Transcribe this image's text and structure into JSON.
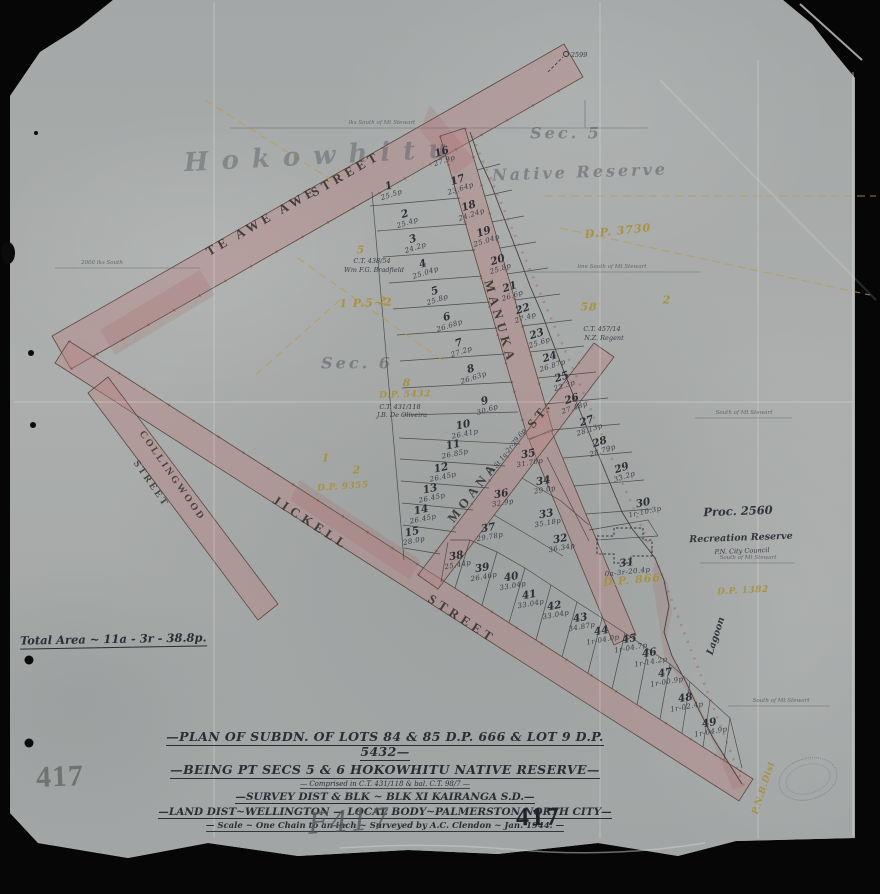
{
  "plan": {
    "total_area": "Total Area ~ 11a - 3r - 38.8p.",
    "title": {
      "l1": "—PLAN OF SUBDN. OF LOTS 84 & 85 D.P. 666 & LOT 9 D.P. 5432—",
      "l2": "—BEING PT SECS 5 & 6 HOKOWHITU NATIVE RESERVE—",
      "l3": "— Comprised in C.T. 431/118 & bal. C.T. 98/7 —",
      "l4": "—SURVEY DIST & BLK ~ BLK XI KAIRANGA S.D.—",
      "l5": "—LAND DIST~WELLINGTON — LOCAL BODY~PALMERSTON NORTH CITY—",
      "l6": "— Scale ~ One Chain to an inch ~ Surveyed by A.C. Clendon ~ Jan. 1944. —"
    },
    "numbers": {
      "stamp_grey": "417",
      "pencil": "F417",
      "ink": "417"
    }
  },
  "lots": [
    {
      "no": "1",
      "a": "25.5p",
      "x": 390,
      "y": 190,
      "r": -18
    },
    {
      "no": "2",
      "a": "25.4p",
      "x": 406,
      "y": 218,
      "r": -18
    },
    {
      "no": "3",
      "a": "24.2p",
      "x": 414,
      "y": 243,
      "r": -18
    },
    {
      "no": "4",
      "a": "25.04p",
      "x": 424,
      "y": 268,
      "r": -18
    },
    {
      "no": "5",
      "a": "25.8p",
      "x": 436,
      "y": 295,
      "r": -18
    },
    {
      "no": "6",
      "a": "26.68p",
      "x": 448,
      "y": 321,
      "r": -18
    },
    {
      "no": "7",
      "a": "27.2p",
      "x": 460,
      "y": 347,
      "r": -18
    },
    {
      "no": "8",
      "a": "26.63p",
      "x": 472,
      "y": 373,
      "r": -18
    },
    {
      "no": "9",
      "a": "30.6p",
      "x": 486,
      "y": 405,
      "r": -18
    },
    {
      "no": "10",
      "a": "26.41p",
      "x": 464,
      "y": 429,
      "r": -12
    },
    {
      "no": "11",
      "a": "26.85p",
      "x": 454,
      "y": 449,
      "r": -12
    },
    {
      "no": "12",
      "a": "26.45p",
      "x": 442,
      "y": 472,
      "r": -12
    },
    {
      "no": "13",
      "a": "26.45p",
      "x": 431,
      "y": 493,
      "r": -12
    },
    {
      "no": "14",
      "a": "26.45p",
      "x": 422,
      "y": 514,
      "r": -12
    },
    {
      "no": "15",
      "a": "28.0p",
      "x": 413,
      "y": 536,
      "r": -12
    },
    {
      "no": "16",
      "a": "27.9p",
      "x": 443,
      "y": 156,
      "r": -18
    },
    {
      "no": "17",
      "a": "23.64p",
      "x": 459,
      "y": 184,
      "r": -18
    },
    {
      "no": "18",
      "a": "24.24p",
      "x": 470,
      "y": 210,
      "r": -18
    },
    {
      "no": "19",
      "a": "25.04p",
      "x": 485,
      "y": 236,
      "r": -18
    },
    {
      "no": "20",
      "a": "25.8p",
      "x": 499,
      "y": 264,
      "r": -18
    },
    {
      "no": "21",
      "a": "26.6p",
      "x": 511,
      "y": 291,
      "r": -18
    },
    {
      "no": "22",
      "a": "27.4p",
      "x": 524,
      "y": 313,
      "r": -18
    },
    {
      "no": "23",
      "a": "25.6p",
      "x": 538,
      "y": 338,
      "r": -18
    },
    {
      "no": "24",
      "a": "26.87p",
      "x": 551,
      "y": 361,
      "r": -18
    },
    {
      "no": "25",
      "a": "22.3p",
      "x": 563,
      "y": 381,
      "r": -18
    },
    {
      "no": "26",
      "a": "27.48p",
      "x": 573,
      "y": 403,
      "r": -18
    },
    {
      "no": "27",
      "a": "28.13p",
      "x": 588,
      "y": 425,
      "r": -18
    },
    {
      "no": "28",
      "a": "28.79p",
      "x": 601,
      "y": 446,
      "r": -18
    },
    {
      "no": "29",
      "a": "33.2p",
      "x": 623,
      "y": 472,
      "r": -18
    },
    {
      "no": "30",
      "a": "1r-10.3p",
      "x": 644,
      "y": 507,
      "r": -12
    },
    {
      "no": "31",
      "a": "0a-3r-20.4p",
      "x": 627,
      "y": 567,
      "r": -6
    },
    {
      "no": "32",
      "a": "36.34p",
      "x": 561,
      "y": 543,
      "r": -10
    },
    {
      "no": "33",
      "a": "35.18p",
      "x": 547,
      "y": 518,
      "r": -10
    },
    {
      "no": "34",
      "a": "29.0p",
      "x": 544,
      "y": 485,
      "r": -10
    },
    {
      "no": "35",
      "a": "31.70p",
      "x": 529,
      "y": 458,
      "r": -10
    },
    {
      "no": "36",
      "a": "32.9p",
      "x": 502,
      "y": 498,
      "r": -10
    },
    {
      "no": "37",
      "a": "29.78p",
      "x": 489,
      "y": 532,
      "r": -10
    },
    {
      "no": "38",
      "a": "25.44p",
      "x": 457,
      "y": 560,
      "r": -10
    },
    {
      "no": "39",
      "a": "26.46p",
      "x": 483,
      "y": 572,
      "r": -10
    },
    {
      "no": "40",
      "a": "33.04p",
      "x": 512,
      "y": 581,
      "r": -10
    },
    {
      "no": "41",
      "a": "33.04p",
      "x": 530,
      "y": 599,
      "r": -10
    },
    {
      "no": "42",
      "a": "33.04p",
      "x": 555,
      "y": 610,
      "r": -10
    },
    {
      "no": "43",
      "a": "34.87p",
      "x": 581,
      "y": 622,
      "r": -10
    },
    {
      "no": "44",
      "a": "1r-04.0p",
      "x": 602,
      "y": 635,
      "r": -10
    },
    {
      "no": "45",
      "a": "1r-04.7p",
      "x": 630,
      "y": 643,
      "r": -10
    },
    {
      "no": "46",
      "a": "1r-14.2p",
      "x": 650,
      "y": 657,
      "r": -10
    },
    {
      "no": "47",
      "a": "1r-00.9p",
      "x": 666,
      "y": 677,
      "r": -10
    },
    {
      "no": "48",
      "a": "1r-02.4p",
      "x": 686,
      "y": 702,
      "r": -10
    },
    {
      "no": "49",
      "a": "1r-04.9p",
      "x": 710,
      "y": 727,
      "r": -10
    }
  ],
  "labels": [
    {
      "n": "street-te-awe-awe",
      "t": "TE AWE AWE",
      "x": 262,
      "y": 221,
      "r": -30,
      "c": "street"
    },
    {
      "n": "street-te-awe-awe-2",
      "t": "STREET",
      "x": 346,
      "y": 174,
      "r": -30,
      "c": "street"
    },
    {
      "n": "street-manuka",
      "t": "MANUKA",
      "x": 500,
      "y": 322,
      "r": 74,
      "c": "street"
    },
    {
      "n": "street-moana",
      "t": "MOANA",
      "x": 473,
      "y": 492,
      "r": -52,
      "c": "street"
    },
    {
      "n": "street-moana-2",
      "t": "ST.",
      "x": 540,
      "y": 414,
      "r": -52,
      "c": "street"
    },
    {
      "n": "street-moana-area",
      "t": "Pt St 1a-2r-29.6p",
      "x": 507,
      "y": 452,
      "r": -52,
      "c": "ink-xs"
    },
    {
      "n": "street-jickell",
      "t": "JICKELL",
      "x": 311,
      "y": 523,
      "r": 33,
      "c": "street"
    },
    {
      "n": "street-jickell-2",
      "t": "STREET",
      "x": 462,
      "y": 619,
      "r": 33,
      "c": "street"
    },
    {
      "n": "street-collingwood",
      "t": "COLLINGWOOD",
      "x": 172,
      "y": 476,
      "r": 55,
      "c": "street-sm"
    },
    {
      "n": "street-collingwood-2",
      "t": "STREET",
      "x": 151,
      "y": 484,
      "r": 55,
      "c": "street-sm"
    },
    {
      "n": "script-hokowhitu",
      "t": "Hokowhitu",
      "x": 322,
      "y": 156,
      "r": -3,
      "c": "script-lg"
    },
    {
      "n": "script-native-reserve",
      "t": "Native Reserve",
      "x": 580,
      "y": 172,
      "r": -2,
      "c": "script-md"
    },
    {
      "n": "script-sec-5",
      "t": "Sec. 5",
      "x": 566,
      "y": 133,
      "r": 0,
      "c": "script-md"
    },
    {
      "n": "script-sec-6",
      "t": "Sec. 6",
      "x": 357,
      "y": 363,
      "r": 0,
      "c": "script-md"
    },
    {
      "n": "dp-3730",
      "t": "D.P. 3730",
      "x": 618,
      "y": 231,
      "r": -6,
      "c": "yellow"
    },
    {
      "n": "yellow-5",
      "t": "5",
      "x": 361,
      "y": 250,
      "r": 0,
      "c": "yellow"
    },
    {
      "n": "yellow-p5-2",
      "t": "1 P.5~2",
      "x": 366,
      "y": 303,
      "r": -2,
      "c": "yellow"
    },
    {
      "n": "yellow-8",
      "t": "8",
      "x": 407,
      "y": 383,
      "r": 0,
      "c": "yellow"
    },
    {
      "n": "dp-5432",
      "t": "D.P. 5432",
      "x": 405,
      "y": 395,
      "r": -2,
      "c": "yellow-sm"
    },
    {
      "n": "yellow-1",
      "t": "1",
      "x": 326,
      "y": 458,
      "r": 0,
      "c": "yellow"
    },
    {
      "n": "yellow-2a",
      "t": "2",
      "x": 357,
      "y": 470,
      "r": 0,
      "c": "yellow"
    },
    {
      "n": "dp-9355",
      "t": "D.P. 9355",
      "x": 343,
      "y": 487,
      "r": -4,
      "c": "yellow-sm"
    },
    {
      "n": "yellow-2b",
      "t": "2",
      "x": 383,
      "y": 301,
      "r": 0,
      "c": "yellow"
    },
    {
      "n": "yellow-58",
      "t": "58",
      "x": 589,
      "y": 307,
      "r": 0,
      "c": "yellow"
    },
    {
      "n": "yellow-2c",
      "t": "2",
      "x": 667,
      "y": 300,
      "r": 0,
      "c": "yellow"
    },
    {
      "n": "dp-866",
      "t": "D.P. 866",
      "x": 632,
      "y": 580,
      "r": -5,
      "c": "yellow"
    },
    {
      "n": "dp-1382",
      "t": "D.P. 1382",
      "x": 743,
      "y": 591,
      "r": -3,
      "c": "yellow-sm"
    },
    {
      "n": "yellow-pnbd",
      "t": "P.N.B.Dist",
      "x": 764,
      "y": 788,
      "r": -72,
      "c": "yellow-sm"
    },
    {
      "n": "note-proc-2560",
      "t": "Proc. 2560",
      "x": 738,
      "y": 511,
      "r": -2,
      "c": "ink-md"
    },
    {
      "n": "note-recreation-reserve",
      "t": "Recreation Reserve",
      "x": 741,
      "y": 538,
      "r": -2,
      "c": "ink-sm"
    },
    {
      "n": "note-city-council",
      "t": "P.N. City Council",
      "x": 742,
      "y": 551,
      "r": -2,
      "c": "ink-xs"
    },
    {
      "n": "note-lagoon",
      "t": "Lagoon",
      "x": 716,
      "y": 636,
      "r": -72,
      "c": "ink-sm"
    },
    {
      "n": "note-ct-438",
      "t": "C.T. 438/54",
      "x": 372,
      "y": 261,
      "r": 0,
      "c": "ink-xs"
    },
    {
      "n": "note-bradfield",
      "t": "Wm F.G. Bradfield",
      "x": 374,
      "y": 270,
      "r": 0,
      "c": "ink-xs"
    },
    {
      "n": "note-ct-431",
      "t": "C.T. 431/118",
      "x": 400,
      "y": 407,
      "r": 0,
      "c": "ink-xs"
    },
    {
      "n": "note-de-oliveira",
      "t": "J.B. De Oliveira",
      "x": 402,
      "y": 415,
      "r": 0,
      "c": "ink-xs"
    },
    {
      "n": "note-ct-457",
      "t": "C.T. 457/14",
      "x": 602,
      "y": 329,
      "r": 0,
      "c": "ink-xs"
    },
    {
      "n": "note-nz-regent",
      "t": "N.Z. Regent",
      "x": 604,
      "y": 338,
      "r": 0,
      "c": "ink-xs"
    },
    {
      "n": "peg-2599",
      "t": "2599",
      "x": 579,
      "y": 55,
      "r": 0,
      "c": "ink-xs"
    },
    {
      "n": "refline-label-1",
      "t": "lks South of Mt Stewart",
      "x": 382,
      "y": 123,
      "r": 0,
      "c": "ink-xxs"
    },
    {
      "n": "refline-label-2",
      "t": "line South of Mt Stewart",
      "x": 612,
      "y": 267,
      "r": 0,
      "c": "ink-xxs"
    },
    {
      "n": "refline-label-3",
      "t": "2000 lks South",
      "x": 102,
      "y": 263,
      "r": 0,
      "c": "ink-xxs"
    },
    {
      "n": "refline-label-4",
      "t": "South of Mt Stewart",
      "x": 744,
      "y": 413,
      "r": 0,
      "c": "ink-xxs"
    },
    {
      "n": "refline-label-5",
      "t": "South of Mt Stewart",
      "x": 748,
      "y": 558,
      "r": 0,
      "c": "ink-xxs"
    },
    {
      "n": "refline-label-6",
      "t": "South of Mt Stewart",
      "x": 781,
      "y": 701,
      "r": 0,
      "c": "ink-xxs"
    }
  ]
}
